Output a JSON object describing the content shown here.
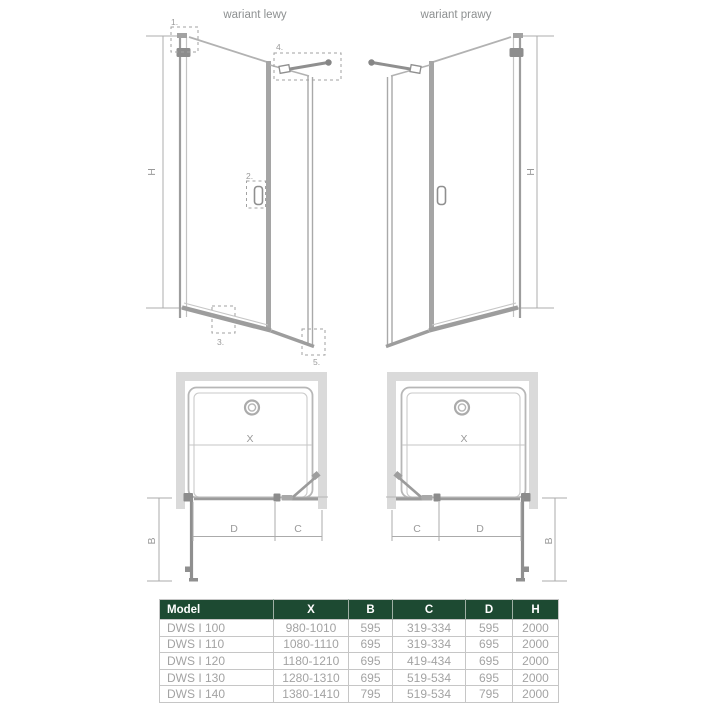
{
  "labels": {
    "left_variant": "wariant lewy",
    "right_variant": "wariant prawy"
  },
  "dimensions": {
    "height": "H",
    "width": "X",
    "side_depth": "B",
    "fixed_part": "C",
    "door_part": "D"
  },
  "callouts": {
    "c1": "1.",
    "c2": "2.",
    "c3": "3.",
    "c4": "4.",
    "c5": "5."
  },
  "table": {
    "headers": [
      "Model",
      "X",
      "B",
      "C",
      "D",
      "H"
    ],
    "rows": [
      [
        "DWS I 100",
        "980-1010",
        "595",
        "319-334",
        "595",
        "2000"
      ],
      [
        "DWS I 110",
        "1080-1110",
        "695",
        "319-334",
        "695",
        "2000"
      ],
      [
        "DWS I 120",
        "1180-1210",
        "695",
        "419-434",
        "695",
        "2000"
      ],
      [
        "DWS I 130",
        "1280-1310",
        "695",
        "519-534",
        "695",
        "2000"
      ],
      [
        "DWS I 140",
        "1380-1410",
        "795",
        "519-534",
        "795",
        "2000"
      ]
    ]
  },
  "colors": {
    "table_header_bg": "#1d4a32",
    "table_header_text": "#ffffff",
    "table_body_text": "#a3a3a3",
    "table_border": "#c6c6c6",
    "drawing_line": "#a6a6a6",
    "drawing_dark": "#8c8c8c",
    "wall_fill": "#dadada",
    "label_text": "#8d9091"
  }
}
